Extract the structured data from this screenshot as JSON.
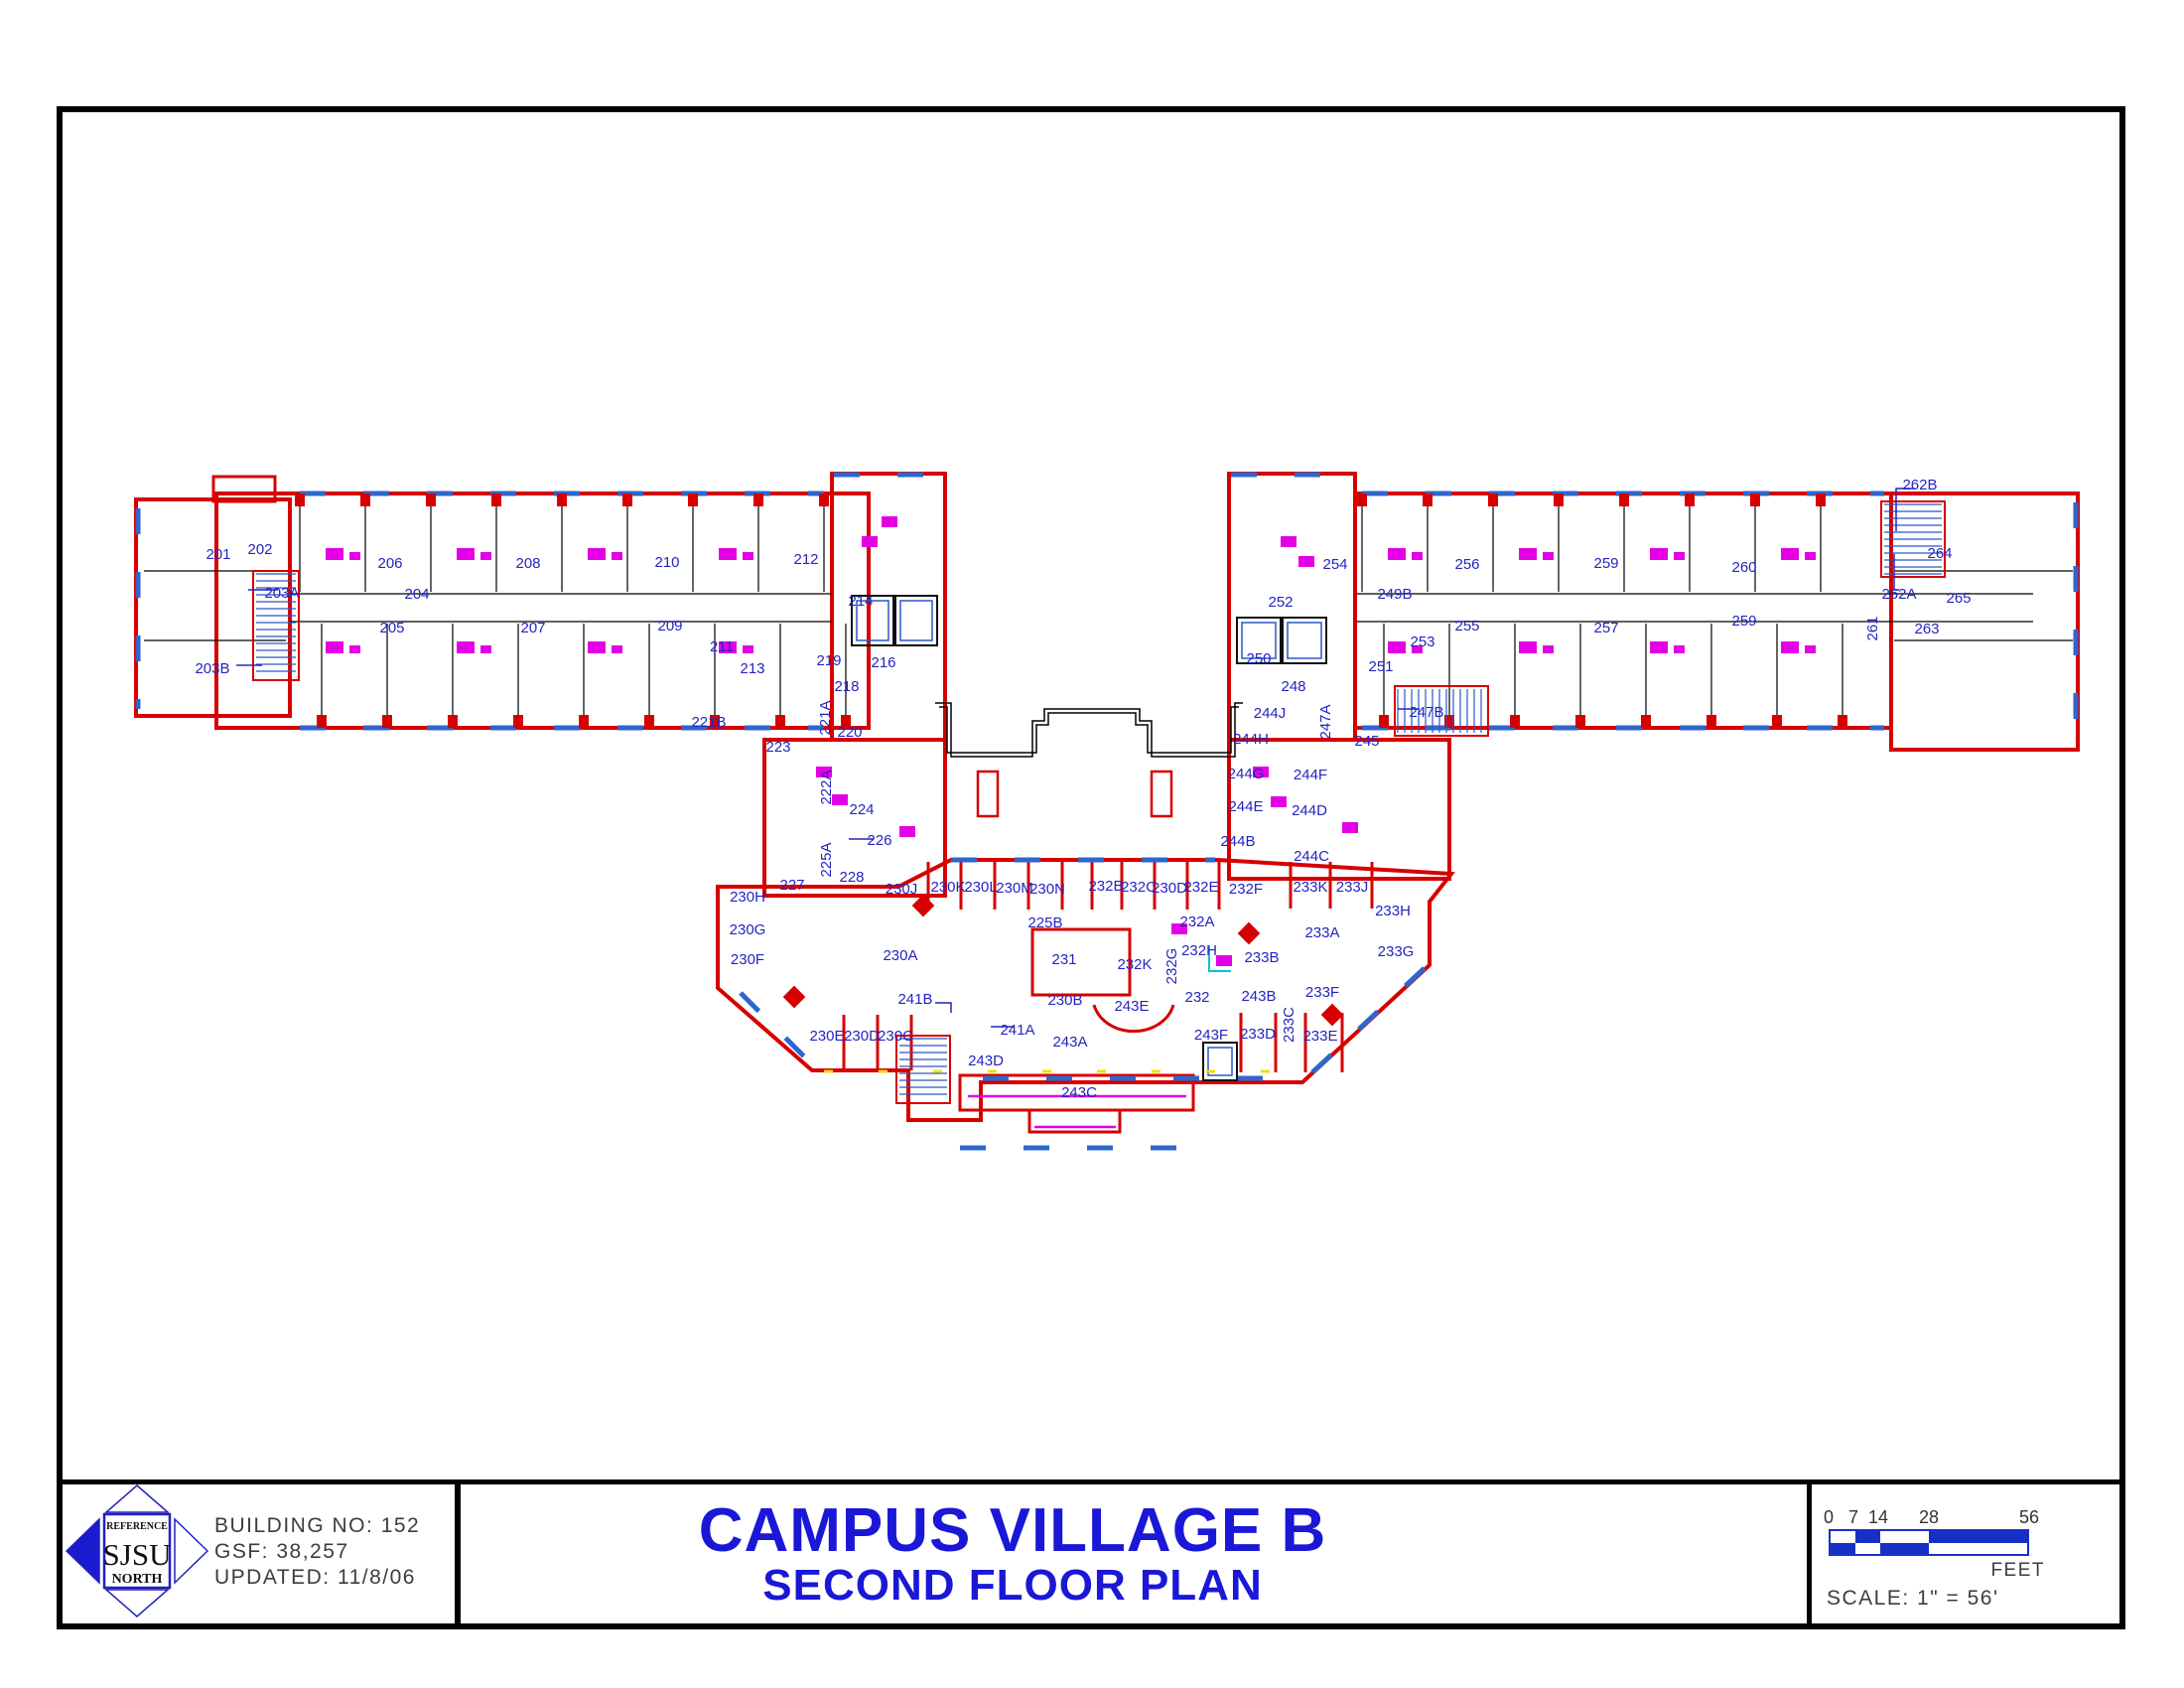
{
  "sheet": {
    "logo": {
      "reference": "REFERENCE",
      "sjsu": "SJSU",
      "north": "NORTH"
    },
    "building_no": "BUILDING NO:  152",
    "gsf": "GSF:  38,257",
    "updated": "UPDATED:  11/8/06",
    "title_line1": "CAMPUS VILLAGE B",
    "title_line2": "SECOND FLOOR PLAN",
    "scale": {
      "ticks": [
        "0",
        "7",
        "14",
        "28",
        "56"
      ],
      "unit": "FEET",
      "scale_text": "SCALE:  1\" = 56'"
    }
  },
  "colors": {
    "wall_red": "#d60000",
    "label_blue": "#2424c0",
    "title_blue": "#1a17d6",
    "window_blue": "#2f66cc",
    "fixture_magenta": "#e400e4",
    "scalebar_blue": "#1830c8",
    "cad_gray": "#3d3d3d",
    "accent_yellow": "#f0e000",
    "accent_cyan": "#00c8c8"
  },
  "plan": {
    "rooms_format": "[label, x, y, vertical?]",
    "rooms": [
      [
        "201",
        220,
        558
      ],
      [
        "202",
        262,
        553
      ],
      [
        "203A",
        284,
        597
      ],
      [
        "203B",
        214,
        673
      ],
      [
        "204",
        420,
        598
      ],
      [
        "205",
        395,
        632
      ],
      [
        "206",
        393,
        567
      ],
      [
        "207",
        537,
        632
      ],
      [
        "208",
        532,
        567
      ],
      [
        "209",
        675,
        630
      ],
      [
        "210",
        672,
        566
      ],
      [
        "211",
        727,
        651
      ],
      [
        "212",
        812,
        563
      ],
      [
        "213",
        758,
        673
      ],
      [
        "214",
        867,
        605
      ],
      [
        "216",
        890,
        667
      ],
      [
        "218",
        853,
        691
      ],
      [
        "219",
        835,
        665
      ],
      [
        "220",
        856,
        737
      ],
      [
        "221A",
        831,
        723,
        1
      ],
      [
        "221B",
        714,
        727
      ],
      [
        "222A",
        832,
        793,
        1
      ],
      [
        "223",
        784,
        752
      ],
      [
        "224",
        868,
        815
      ],
      [
        "225A",
        832,
        866,
        1
      ],
      [
        "225B",
        1053,
        929
      ],
      [
        "226",
        886,
        846
      ],
      [
        "227",
        798,
        891
      ],
      [
        "228",
        858,
        883
      ],
      [
        "230A",
        907,
        962
      ],
      [
        "230B",
        1073,
        1007
      ],
      [
        "230C",
        902,
        1043
      ],
      [
        "230D",
        868,
        1043
      ],
      [
        "230E",
        833,
        1043
      ],
      [
        "230F",
        753,
        966
      ],
      [
        "230G",
        753,
        936
      ],
      [
        "230H",
        753,
        903
      ],
      [
        "230J",
        908,
        895
      ],
      [
        "230K",
        955,
        893
      ],
      [
        "230L",
        988,
        893
      ],
      [
        "230M",
        1022,
        894
      ],
      [
        "230N",
        1055,
        895
      ],
      [
        "231",
        1072,
        966
      ],
      [
        "232",
        1206,
        1004
      ],
      [
        "232A",
        1206,
        928
      ],
      [
        "232B",
        1114,
        892
      ],
      [
        "232C",
        1147,
        893
      ],
      [
        "230D",
        1178,
        894
      ],
      [
        "232E",
        1210,
        893
      ],
      [
        "232F",
        1255,
        895
      ],
      [
        "232G",
        1180,
        973,
        1
      ],
      [
        "232H",
        1208,
        957
      ],
      [
        "232K",
        1143,
        971
      ],
      [
        "233A",
        1332,
        939
      ],
      [
        "233B",
        1271,
        964
      ],
      [
        "233C",
        1298,
        1032,
        1
      ],
      [
        "233D",
        1267,
        1041
      ],
      [
        "233E",
        1330,
        1043
      ],
      [
        "233F",
        1332,
        999
      ],
      [
        "233G",
        1406,
        958
      ],
      [
        "233H",
        1403,
        917
      ],
      [
        "233J",
        1362,
        893
      ],
      [
        "233K",
        1320,
        893
      ],
      [
        "241A",
        1025,
        1037
      ],
      [
        "241B",
        922,
        1006
      ],
      [
        "243A",
        1078,
        1049
      ],
      [
        "243B",
        1268,
        1003
      ],
      [
        "243C",
        1087,
        1100
      ],
      [
        "243D",
        993,
        1068
      ],
      [
        "243E",
        1140,
        1013
      ],
      [
        "243F",
        1220,
        1042
      ],
      [
        "244B",
        1247,
        847
      ],
      [
        "244C",
        1321,
        862
      ],
      [
        "244D",
        1319,
        816
      ],
      [
        "244E",
        1255,
        812
      ],
      [
        "244F",
        1320,
        780
      ],
      [
        "244G",
        1255,
        779
      ],
      [
        "244H",
        1260,
        744
      ],
      [
        "244J",
        1279,
        718
      ],
      [
        "245",
        1377,
        746
      ],
      [
        "247A",
        1335,
        727,
        1
      ],
      [
        "247B",
        1437,
        717
      ],
      [
        "248",
        1303,
        691
      ],
      [
        "249B",
        1405,
        598
      ],
      [
        "250",
        1268,
        663
      ],
      [
        "251",
        1391,
        671
      ],
      [
        "252",
        1290,
        606
      ],
      [
        "253",
        1433,
        646
      ],
      [
        "254",
        1345,
        568
      ],
      [
        "255",
        1478,
        630
      ],
      [
        "256",
        1478,
        568
      ],
      [
        "257",
        1618,
        632
      ],
      [
        "259",
        1618,
        567
      ],
      [
        "259",
        1757,
        625
      ],
      [
        "260",
        1757,
        571
      ],
      [
        "261",
        1886,
        633,
        1
      ],
      [
        "262A",
        1913,
        598
      ],
      [
        "262B",
        1934,
        488
      ],
      [
        "263",
        1941,
        633
      ],
      [
        "264",
        1954,
        557
      ],
      [
        "265",
        1973,
        602
      ]
    ]
  }
}
